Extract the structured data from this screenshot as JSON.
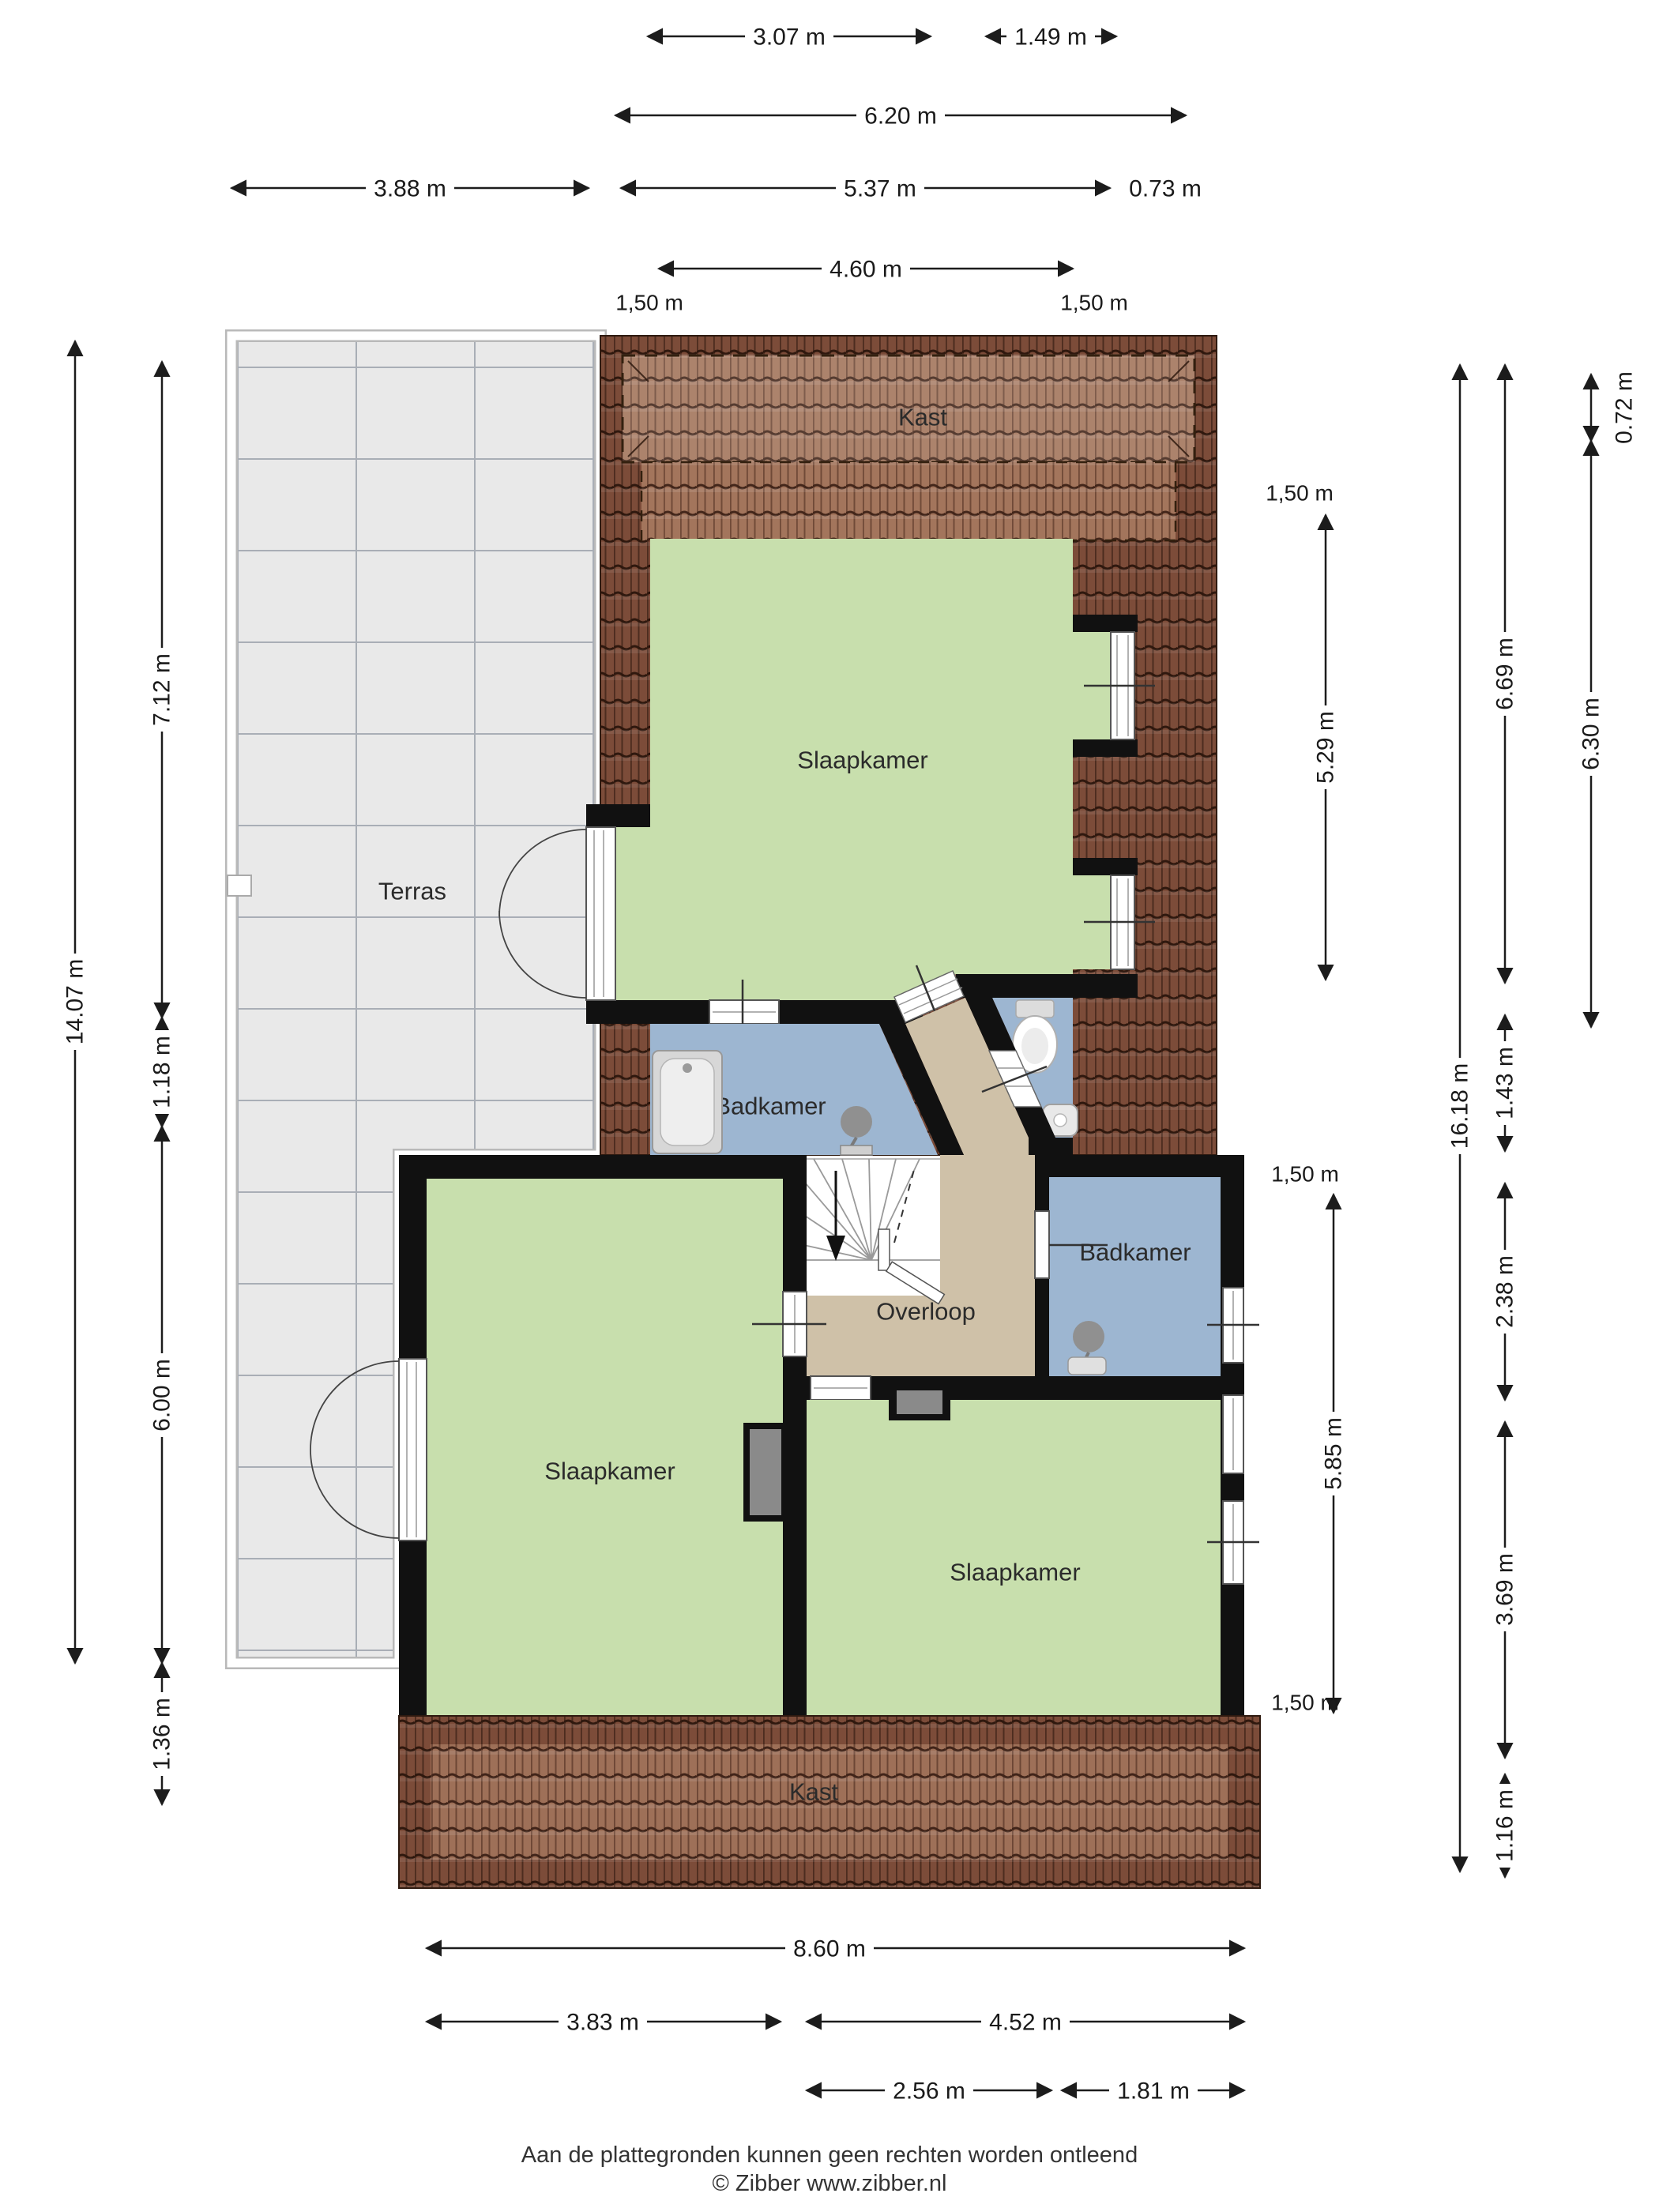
{
  "rooms": {
    "terrace": "Terras",
    "closet_top": "Kast",
    "bedroom_top": "Slaapkamer",
    "bathroom_left": "Badkamer",
    "landing": "Overloop",
    "bathroom_right": "Badkamer",
    "bedroom_left": "Slaapkamer",
    "bedroom_right": "Slaapkamer",
    "closet_bottom": "Kast"
  },
  "dimensions": {
    "top": [
      "3.07 m",
      "1.49 m",
      "6.20 m",
      "3.88 m",
      "5.37 m",
      "0.73 m",
      "4.60 m"
    ],
    "top_knee": [
      "1,50 m",
      "1,50 m"
    ],
    "left": [
      "14.07 m",
      "7.12 m",
      "1.18 m",
      "6.00 m",
      "1.36 m"
    ],
    "right_outer": [
      "16.18 m",
      "6.69 m",
      "1.43 m",
      "2.38 m",
      "3.69 m",
      "1.16 m"
    ],
    "right_far": [
      "0.72 m",
      "6.30 m"
    ],
    "inner_right": [
      "1,50 m",
      "5.29 m",
      "1,50 m",
      "5.85 m",
      "1,50 m"
    ],
    "bottom": [
      "8.60 m",
      "3.83 m",
      "4.52 m",
      "2.56 m",
      "1.81 m"
    ]
  },
  "footer": {
    "line1": "Aan de plattegronden kunnen geen rechten worden ontleend",
    "line2": "© Zibber www.zibber.nl"
  },
  "colors": {
    "room_green": "#c8dfad",
    "room_blue": "#9db6d1",
    "landing_tan": "#cfc1a8",
    "terrace_grey": "#e9e9e9",
    "roof_dark": "#7c4c39",
    "roof_light": "#a3755c",
    "wall": "#111111"
  }
}
